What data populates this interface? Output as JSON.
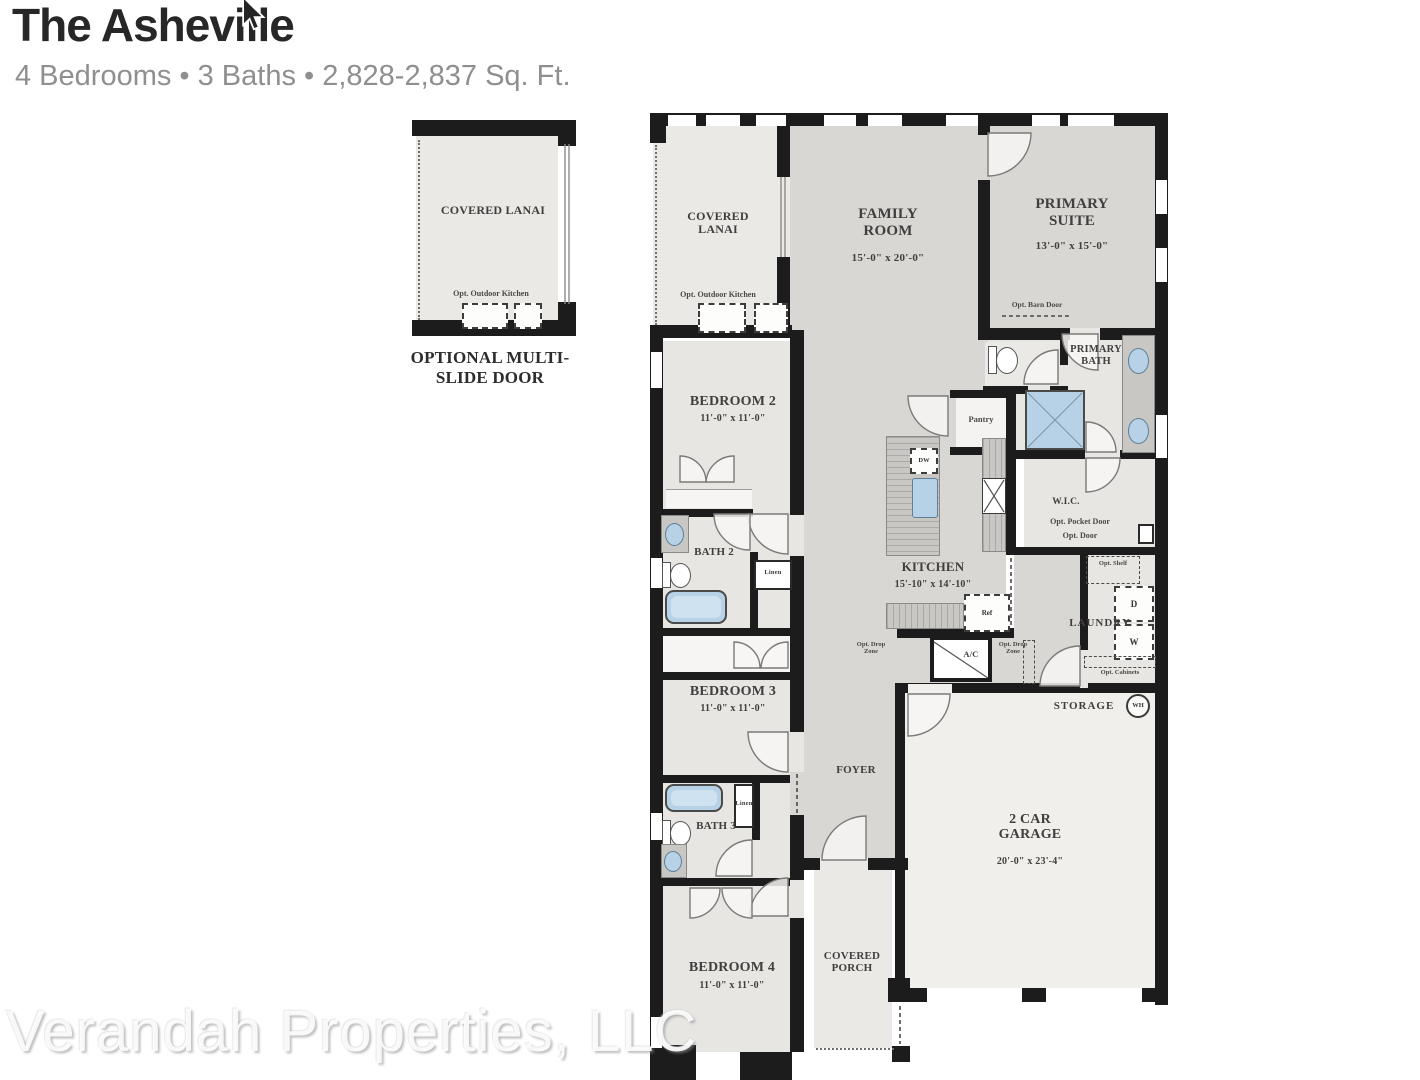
{
  "header": {
    "title": "The Asheville",
    "subtitle": "4 Bedrooms • 3 Baths • 2,828-2,837 Sq. Ft."
  },
  "watermark": "Verandah Properties, LLC",
  "inset": {
    "room": "COVERED LANAI",
    "opt": "Opt. Outdoor Kitchen",
    "caption": "OPTIONAL MULTI-SLIDE DOOR"
  },
  "rooms": {
    "lanai": {
      "name": "COVERED LANAI",
      "opt": "Opt. Outdoor Kitchen"
    },
    "family": {
      "name": "FAMILY ROOM",
      "dims": "15'-0\" x 20'-0\""
    },
    "primary_suite": {
      "name": "PRIMARY SUITE",
      "dims": "13'-0\" x 15'-0\"",
      "barn": "Opt. Barn Door"
    },
    "primary_bath": {
      "name": "PRIMARY BATH"
    },
    "pantry": {
      "name": "Pantry"
    },
    "wic": {
      "name": "W.I.C.",
      "pocket": "Opt. Pocket Door",
      "door": "Opt. Door"
    },
    "laundry": {
      "name": "LAUNDRY",
      "shelf": "Opt. Shelf",
      "dryer": "D",
      "washer": "W",
      "cabinets": "Opt. Cabinets"
    },
    "kitchen": {
      "name": "KITCHEN",
      "dims": "15'-10\" x 14'-10\"",
      "dw": "DW",
      "ref": "Ref"
    },
    "bedroom2": {
      "name": "BEDROOM 2",
      "dims": "11'-0\" x 11'-0\""
    },
    "bath2": {
      "name": "BATH 2",
      "linen": "Linen"
    },
    "bedroom3": {
      "name": "BEDROOM 3",
      "dims": "11'-0\" x 11'-0\""
    },
    "bath3": {
      "name": "BATH 3",
      "linen": "Linen"
    },
    "bedroom4": {
      "name": "BEDROOM 4",
      "dims": "11'-0\" x 11'-0\""
    },
    "foyer": {
      "name": "FOYER"
    },
    "garage": {
      "name": "2 CAR GARAGE",
      "dims": "20'-0\" x 23'-4\"",
      "storage": "STORAGE",
      "wh": "WH"
    },
    "porch": {
      "name": "COVERED PORCH"
    },
    "hall": {
      "drop1": "Opt. Drop Zone",
      "drop2": "Opt. Drop Zone",
      "ac": "A/C"
    }
  },
  "colors": {
    "wall": "#1c1c1c",
    "gray_main": "#d8d7d4",
    "gray_bed": "#e7e6e3",
    "gray_outdoor": "#eae9e6",
    "gray_garage": "#f0efec",
    "fixture_blue": "#b7d2e6"
  }
}
